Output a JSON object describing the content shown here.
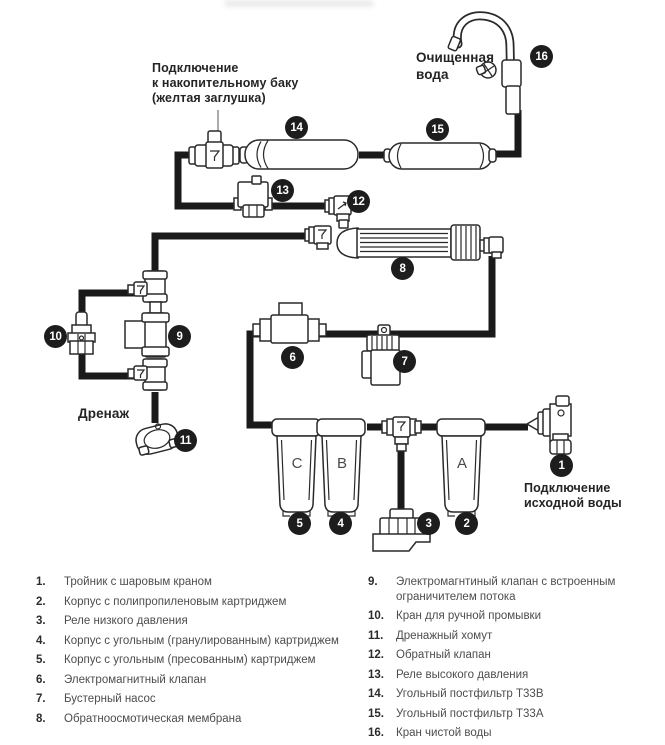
{
  "diagram": {
    "labels": {
      "tank": "Подключение\nк накопительному баку\n(желтая заглушка)",
      "clean_water": "Очищенная\nвода",
      "drain": "Дренаж",
      "source": "Подключение\nисходной воды"
    },
    "housing_letters": {
      "c": "C",
      "b": "B",
      "a": "A"
    },
    "badges": {
      "b1": "1",
      "b2": "2",
      "b3": "3",
      "b4": "4",
      "b5": "5",
      "b6": "6",
      "b7": "7",
      "b8": "8",
      "b9": "9",
      "b10": "10",
      "b11": "11",
      "b12": "12",
      "b13": "13",
      "b14": "14",
      "b15": "15",
      "b16": "16"
    },
    "icons": [
      "tee-with-ball-valve-icon",
      "filter-housing-icon",
      "low-pressure-switch-icon",
      "solenoid-valve-icon",
      "booster-pump-icon",
      "ro-membrane-icon",
      "flush-valve-icon",
      "drain-clamp-icon",
      "check-valve-icon",
      "high-pressure-switch-icon",
      "inline-postfilter-icon",
      "gooseneck-faucet-icon"
    ],
    "colors": {
      "line": "#1a1a1a",
      "badge": "#1d1d1d",
      "text": "#4d4d4d",
      "heading": "#242424"
    }
  },
  "legend": {
    "left": [
      {
        "num": "1.",
        "text": "Тройник с шаровым краном"
      },
      {
        "num": "2.",
        "text": "Корпус с полипропиленовым картриджем"
      },
      {
        "num": "3.",
        "text": "Реле низкого давления"
      },
      {
        "num": "4.",
        "text": "Корпус с угольным (гранулированным) картриджем"
      },
      {
        "num": "5.",
        "text": "Корпус с угольным (пресованным) картриджем"
      },
      {
        "num": "6.",
        "text": "Электромагнитный клапан"
      },
      {
        "num": "7.",
        "text": "Бустерный насос"
      },
      {
        "num": "8.",
        "text": "Обратноосмотическая мембрана"
      }
    ],
    "right": [
      {
        "num": "9.",
        "text": "Электромагнтиный клапан с встроенным ограничителем потока"
      },
      {
        "num": "10.",
        "text": "Кран для ручной промывки"
      },
      {
        "num": "11.",
        "text": "Дренажный хомут"
      },
      {
        "num": "12.",
        "text": "Обратный клапан"
      },
      {
        "num": "13.",
        "text": "Реле высокого давления"
      },
      {
        "num": "14.",
        "text": "Угольный постфильтр Т33В"
      },
      {
        "num": "15.",
        "text": "Угольный постфильтр Т33А"
      },
      {
        "num": "16.",
        "text": "Кран чистой воды"
      }
    ]
  }
}
